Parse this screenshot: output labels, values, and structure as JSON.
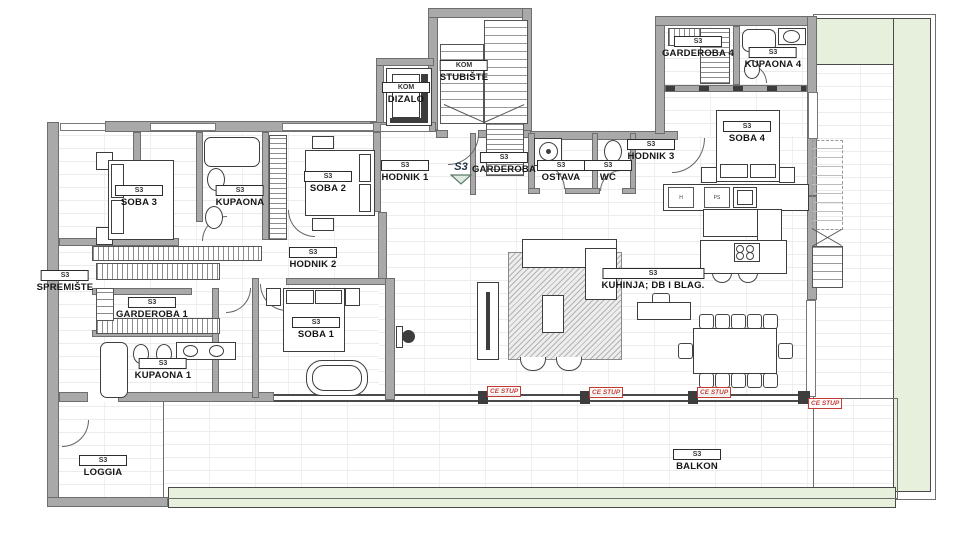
{
  "plan": {
    "title": "apartment-floor-plan",
    "unit_code": "S3",
    "entrance_label": "S3",
    "rooms": [
      {
        "id": "spremiste",
        "code": "S3",
        "name": "SPREMIŠTE"
      },
      {
        "id": "soba3",
        "code": "S3",
        "name": "SOBA 3"
      },
      {
        "id": "kupaona",
        "code": "S3",
        "name": "KUPAONA"
      },
      {
        "id": "soba2",
        "code": "S3",
        "name": "SOBA 2"
      },
      {
        "id": "hodnik1",
        "code": "S3",
        "name": "HODNIK 1"
      },
      {
        "id": "dizalo",
        "code": "KOM",
        "name": "DIZALO"
      },
      {
        "id": "stubiste",
        "code": "KOM",
        "name": "STUBIŠTE"
      },
      {
        "id": "garderoba",
        "code": "S3",
        "name": "GARDEROBA"
      },
      {
        "id": "ostava",
        "code": "S3",
        "name": "OSTAVA"
      },
      {
        "id": "wc",
        "code": "S3",
        "name": "WC"
      },
      {
        "id": "hodnik3",
        "code": "S3",
        "name": "HODNIK 3"
      },
      {
        "id": "garderoba4",
        "code": "S3",
        "name": "GARDEROBA 4"
      },
      {
        "id": "kupaona4",
        "code": "S3",
        "name": "KUPAONA 4"
      },
      {
        "id": "soba4",
        "code": "S3",
        "name": "SOBA 4"
      },
      {
        "id": "hodnik2",
        "code": "S3",
        "name": "HODNIK 2"
      },
      {
        "id": "garderoba1",
        "code": "S3",
        "name": "GARDEROBA 1"
      },
      {
        "id": "soba1",
        "code": "S3",
        "name": "SOBA 1"
      },
      {
        "id": "kupaona1",
        "code": "S3",
        "name": "KUPAONA 1"
      },
      {
        "id": "kuhinja",
        "code": "S3",
        "name": "KUHINJA; DB I BLAG."
      },
      {
        "id": "loggia",
        "code": "S3",
        "name": "LOGGIA"
      },
      {
        "id": "balkon",
        "code": "S3",
        "name": "BALKON"
      }
    ],
    "column_labels": [
      "CE STUP",
      "CE STUP",
      "CE STUP",
      "CE STUP"
    ],
    "cabinets": [
      {
        "label": "H"
      },
      {
        "label": "PS"
      }
    ],
    "colors": {
      "wall": "#a9a9a9",
      "wall_line": "#6e6e6e",
      "tile_line": "#ececec",
      "planter_green": "#e7efdd",
      "column_red": "#c23b33",
      "ink": "#161616",
      "entrance_marker": "#203246"
    }
  }
}
